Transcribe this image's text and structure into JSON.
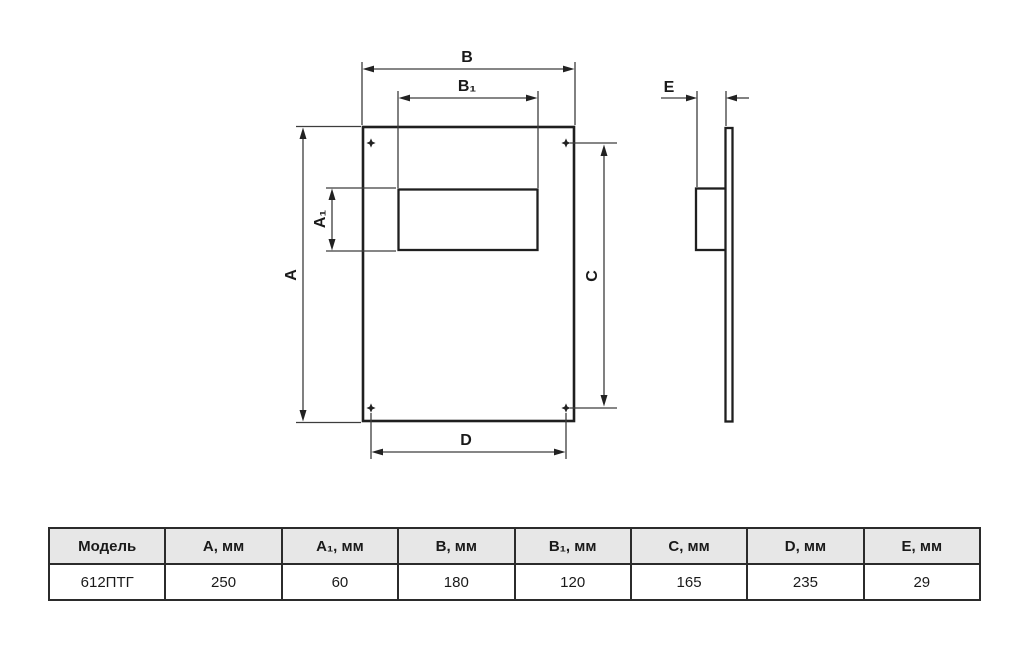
{
  "drawing": {
    "labels": {
      "b": "B",
      "b1": "B₁",
      "a": "A",
      "a1": "A₁",
      "c": "C",
      "d": "D",
      "e": "E"
    },
    "colors": {
      "outline": "#1f1f1f",
      "dim_line": "#3d3d3d",
      "label_text": "#1a1a1a"
    }
  },
  "table": {
    "headers": [
      "Модель",
      "А, мм",
      "А₁, мм",
      "В, мм",
      "В₁, мм",
      "С, мм",
      "D, мм",
      "Е, мм"
    ],
    "rows": [
      [
        "612ПТГ",
        "250",
        "60",
        "180",
        "120",
        "165",
        "235",
        "29"
      ]
    ],
    "header_bg": "#e7e7e7",
    "border_color": "#2b2b2b"
  }
}
